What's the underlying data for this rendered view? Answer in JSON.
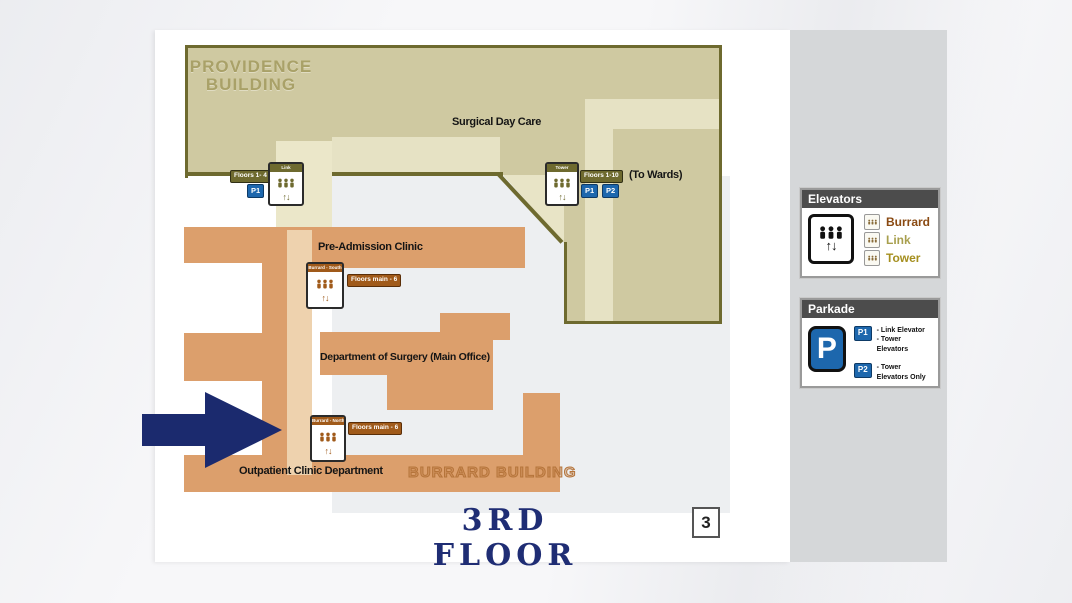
{
  "map": {
    "providence_label": "PROVIDENCE\nBUILDING",
    "burrard_label": "BURRARD BUILDING",
    "areas": {
      "surgical_day_care": "Surgical Day Care",
      "to_wards": "(To Wards)",
      "pre_admission": "Pre-Admission Clinic",
      "surgery": "Department of Surgery (Main Office)",
      "outpatient": "Outpatient Clinic Department"
    },
    "badges": {
      "floors_1_4": "Floors 1- 4",
      "floors_1_10": "Floors 1-10",
      "floors_main_6": "Floors main - 6",
      "p1": "P1",
      "p2": "P2"
    },
    "elevators": {
      "link": "Link",
      "tower": "Tower",
      "burrard_south": "Burrard - South",
      "burrard_north": "Burrard - North"
    },
    "elevator_arrows": "↑↓",
    "title": "3RD FLOOR",
    "page_number": "3"
  },
  "legend": {
    "elevators": {
      "title": "Elevators",
      "arrows": "↑↓",
      "items": [
        {
          "label": "Burrard",
          "color": "#8a4a12"
        },
        {
          "label": "Link",
          "color": "#a89f4e"
        },
        {
          "label": "Tower",
          "color": "#a58f1f"
        }
      ]
    },
    "parkade": {
      "title": "Parkade",
      "symbol": "P",
      "entries": [
        {
          "badge": "P1",
          "text": "- Link Elevator\n- Tower Elevators"
        },
        {
          "badge": "P2",
          "text": "- Tower Elevators Only"
        }
      ]
    }
  },
  "colors": {
    "navy": "#1b2a6e",
    "khaki": "#cfc9a1",
    "khaki_light": "#e6e2c4",
    "olive_border": "#6e6a2f",
    "orange": "#dc9f6c",
    "peach_corridor": "#eed2ae",
    "cream_corridor": "#ebe7c9",
    "map_gray": "#edeff1",
    "panel_gray": "#d5d7d9",
    "blue": "#1d67ad",
    "brown": "#a05a1a",
    "title_navy": "#1f2d74"
  }
}
